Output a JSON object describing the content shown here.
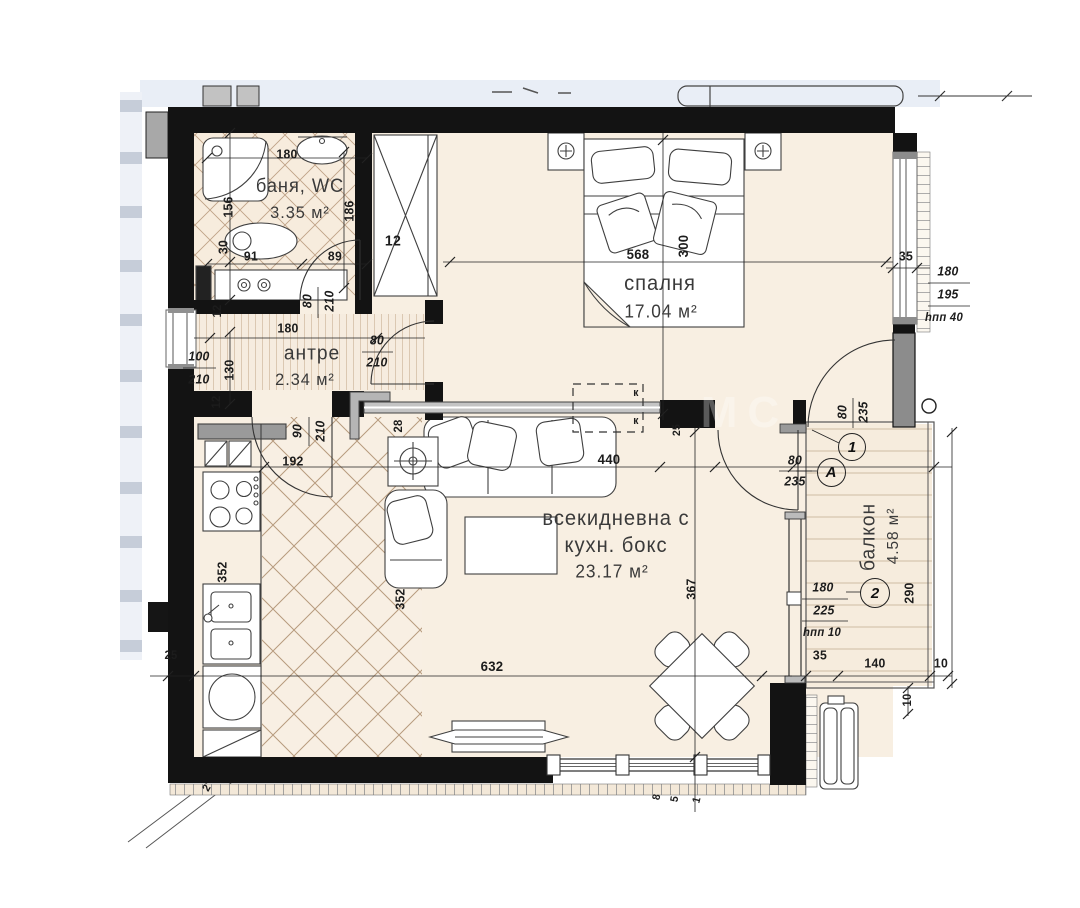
{
  "title": "Апартамент — разпределение (floor plan)",
  "colors": {
    "wall": "#131313",
    "floor": "#f8efe2",
    "tile-line": "#b99d80",
    "window-gray": "#8c8c8c",
    "beam-gray": "#c4c4c4",
    "dim-color": "#1c1c1c",
    "exterior-band": "#e9eef6",
    "deck-line": "#cdbba4"
  },
  "rooms": [
    {
      "id": "bathroom",
      "name": "баня, WC",
      "area": "3.35 м²"
    },
    {
      "id": "bedroom",
      "name": "спалня",
      "area": "17.04 м²"
    },
    {
      "id": "hallway",
      "name": "антре",
      "area": "2.34 м²"
    },
    {
      "id": "living",
      "name_line1": "всекидневна с",
      "name_line2": "кухн. бокс",
      "area": "23.17 м²"
    },
    {
      "id": "balcony",
      "name": "балкон",
      "area": "4.58 м²"
    }
  ],
  "watermark": {
    "text": "МС"
  },
  "markers": [
    {
      "t": "1",
      "x": 851,
      "y": 446,
      "d": 26
    },
    {
      "t": "А",
      "x": 830,
      "y": 471,
      "d": 27
    },
    {
      "t": "2",
      "x": 874,
      "y": 592,
      "d": 28
    }
  ],
  "dims": [
    {
      "t": "180",
      "x": 287,
      "y": 154
    },
    {
      "t": "156",
      "x": 228,
      "y": 207,
      "r": -90
    },
    {
      "t": "30",
      "x": 223,
      "y": 247,
      "r": -90
    },
    {
      "t": "91",
      "x": 251,
      "y": 256
    },
    {
      "t": "89",
      "x": 335,
      "y": 256
    },
    {
      "t": "186",
      "x": 349,
      "y": 211,
      "r": -90
    },
    {
      "t": "12",
      "x": 393,
      "y": 241,
      "s": 15
    },
    {
      "t": "12",
      "x": 217,
      "y": 311,
      "r": -90,
      "s": 12
    },
    {
      "t": "180",
      "x": 288,
      "y": 328
    },
    {
      "t": "100",
      "x": 199,
      "y": 356,
      "i": 1
    },
    {
      "t": "210",
      "x": 199,
      "y": 379,
      "i": 1
    },
    {
      "t": "130",
      "x": 229,
      "y": 370,
      "r": -90
    },
    {
      "t": "12",
      "x": 216,
      "y": 402,
      "r": -90,
      "s": 12
    },
    {
      "t": "80",
      "x": 307,
      "y": 301,
      "r": -90,
      "i": 1
    },
    {
      "t": "210",
      "x": 329,
      "y": 301,
      "r": -90,
      "i": 1
    },
    {
      "t": "80",
      "x": 377,
      "y": 340,
      "i": 1
    },
    {
      "t": "210",
      "x": 377,
      "y": 362,
      "i": 1
    },
    {
      "t": "90",
      "x": 297,
      "y": 431,
      "r": -90,
      "i": 1
    },
    {
      "t": "210",
      "x": 320,
      "y": 431,
      "r": -90,
      "i": 1
    },
    {
      "t": "192",
      "x": 293,
      "y": 461
    },
    {
      "t": "568",
      "x": 638,
      "y": 254,
      "s": 14
    },
    {
      "t": "300",
      "x": 683,
      "y": 246,
      "r": -90,
      "s": 14
    },
    {
      "t": "440",
      "x": 609,
      "y": 459,
      "s": 14
    },
    {
      "t": "28",
      "x": 398,
      "y": 426,
      "r": -90,
      "s": 12
    },
    {
      "t": "25",
      "x": 677,
      "y": 430,
      "r": -90,
      "s": 11
    },
    {
      "t": "к",
      "x": 636,
      "y": 393,
      "s": 11
    },
    {
      "t": "к",
      "x": 636,
      "y": 421,
      "s": 11
    },
    {
      "t": "352",
      "x": 222,
      "y": 572,
      "r": -90
    },
    {
      "t": "352",
      "x": 400,
      "y": 599,
      "r": -90
    },
    {
      "t": "367",
      "x": 691,
      "y": 589,
      "r": -90
    },
    {
      "t": "632",
      "x": 492,
      "y": 666,
      "s": 14
    },
    {
      "t": "25",
      "x": 171,
      "y": 655,
      "s": 12
    },
    {
      "t": "35",
      "x": 906,
      "y": 256
    },
    {
      "t": "180",
      "x": 948,
      "y": 271,
      "i": 1
    },
    {
      "t": "195",
      "x": 948,
      "y": 294,
      "i": 1
    },
    {
      "t": "hпп 40",
      "x": 944,
      "y": 317,
      "i": 1,
      "s": 12
    },
    {
      "t": "80",
      "x": 795,
      "y": 460,
      "i": 1
    },
    {
      "t": "235",
      "x": 795,
      "y": 481,
      "i": 1
    },
    {
      "t": "80",
      "x": 842,
      "y": 412,
      "r": -90,
      "i": 1
    },
    {
      "t": "235",
      "x": 863,
      "y": 412,
      "r": -90,
      "i": 1
    },
    {
      "t": "180",
      "x": 823,
      "y": 587,
      "i": 1
    },
    {
      "t": "225",
      "x": 824,
      "y": 610,
      "i": 1
    },
    {
      "t": "hпп 10",
      "x": 822,
      "y": 632,
      "i": 1,
      "s": 12
    },
    {
      "t": "290",
      "x": 909,
      "y": 593,
      "r": -90
    },
    {
      "t": "35",
      "x": 820,
      "y": 655
    },
    {
      "t": "140",
      "x": 875,
      "y": 663
    },
    {
      "t": "10",
      "x": 941,
      "y": 663
    },
    {
      "t": "10",
      "x": 907,
      "y": 700,
      "r": -90,
      "s": 12
    },
    {
      "t": "8",
      "x": 657,
      "y": 797,
      "r": -80,
      "s": 11
    },
    {
      "t": "5",
      "x": 675,
      "y": 799,
      "r": -80,
      "s": 11
    },
    {
      "t": "1",
      "x": 697,
      "y": 800,
      "r": -75,
      "s": 11
    },
    {
      "t": "2",
      "x": 207,
      "y": 788,
      "r": -60,
      "s": 11
    }
  ]
}
